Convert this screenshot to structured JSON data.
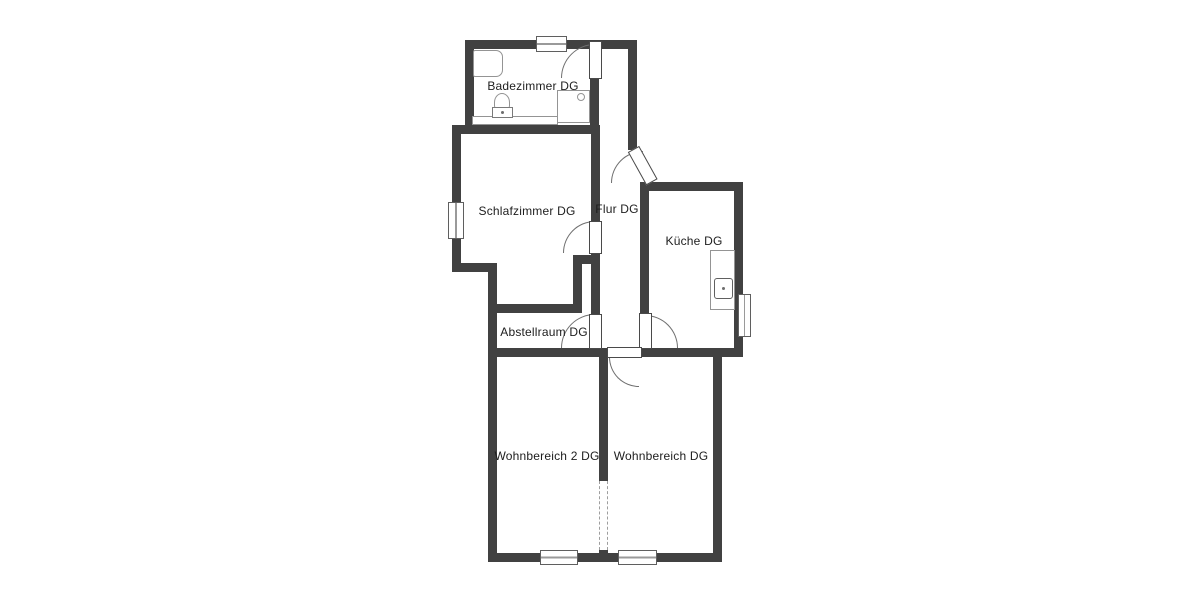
{
  "plan_title": "Dachgeschoss Grundriss",
  "colors": {
    "wall": "#414141",
    "label": "#1d1d1d",
    "arc": "#6f6f6f",
    "fixture": "#949494"
  },
  "rooms": [
    {
      "id": "badezimmer",
      "label": "Badezimmer DG"
    },
    {
      "id": "schlafzimmer",
      "label": "Schlafzimmer DG"
    },
    {
      "id": "flur",
      "label": "Flur DG"
    },
    {
      "id": "kueche",
      "label": "Küche DG"
    },
    {
      "id": "abstellraum",
      "label": "Abstellraum DG"
    },
    {
      "id": "wohnbereich2",
      "label": "Wohnbereich 2 DG"
    },
    {
      "id": "wohnbereich",
      "label": "Wohnbereich DG"
    }
  ],
  "fixtures": [
    "bathtub",
    "toilet",
    "shower-tray",
    "bathroom-counter",
    "kitchen-counter",
    "kitchen-sink"
  ],
  "openings": {
    "doors": 6,
    "windows": 5,
    "dashed_wall_opening": 1
  }
}
